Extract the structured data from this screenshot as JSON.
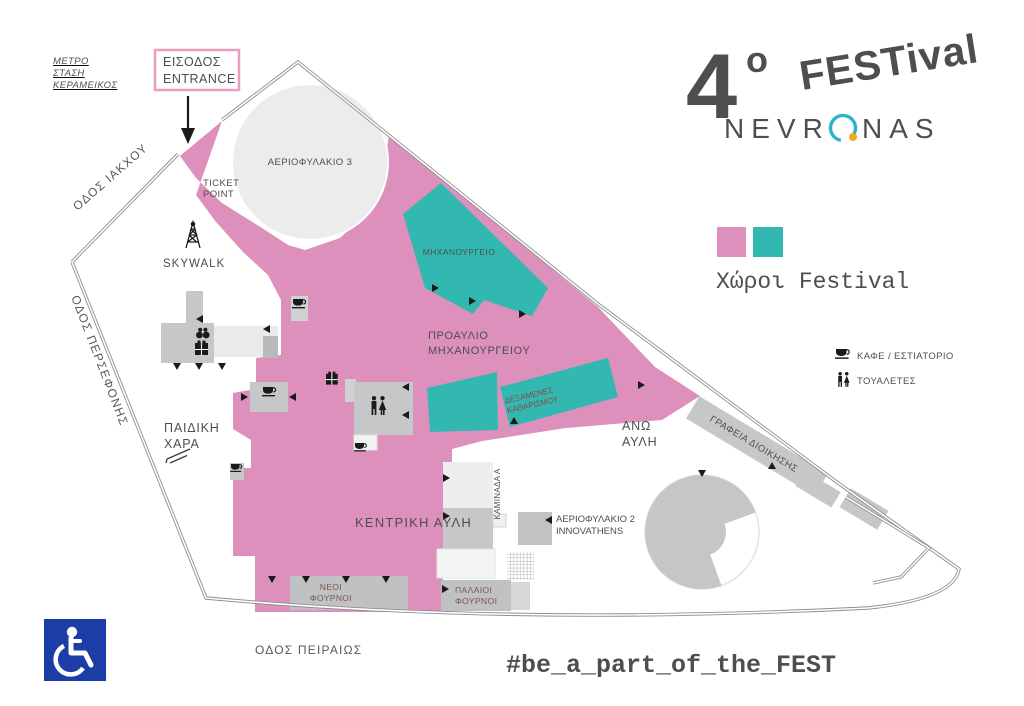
{
  "colors": {
    "festival_pink": "#dd90bc",
    "festival_teal": "#33b8b1",
    "building_gray": "#c5c7c9",
    "building_light": "#e9eaeb",
    "outline_gray": "#8d8f91",
    "label_dark": "#4d4e50",
    "label_brown": "#7d5648",
    "label_maroon": "#8a4a42",
    "logo_pink": "#d791bf",
    "logo_teal_arc": "#2bb3c8",
    "logo_orange_dot": "#f8a51b",
    "accessibility_blue": "#1d3da6",
    "entrance_box_border": "#ed9dc3"
  },
  "logo": {
    "number": "4",
    "ordinal": "o",
    "festival": "FESTival",
    "brand_left": "NEVR",
    "brand_right": "NAS"
  },
  "legend": {
    "title": "Χώροι Festival",
    "cafe": "ΚΑΦΕ / ΕΣΤΙΑΤΟΡΙΟ",
    "toilets": "ΤΟΥΑΛΕΤΕΣ"
  },
  "hashtag": "#be_a_part_of_the_FEST",
  "entrance": {
    "line1": "ΕΙΣΟΔΟΣ",
    "line2": "ENTRANCE"
  },
  "metro": {
    "line1": "ΜΕΤΡΟ",
    "line2": "ΣΤΑΣΗ",
    "line3": "ΚΕΡΑΜΕΙΚΟΣ"
  },
  "streets": {
    "iakchou": "ΟΔΟΣ ΙΑΚΧΟΥ",
    "persefonis": "ΟΔΟΣ ΠΕΡΣΕΦΟΝΗΣ",
    "peiraios": "ΟΔΟΣ ΠΕΙΡΑΙΩΣ"
  },
  "labels": {
    "ticket_point": {
      "line1": "TICKET",
      "line2": "POINT"
    },
    "skywalk": "SKYWALK",
    "gasholder3": "ΑΕΡΙΟΦΥΛΑΚΙΟ 3",
    "machine_shop": "ΜΗΧΑΝΟΥΡΓΕΙΟ",
    "machine_shop_forecourt": {
      "line1": "ΠΡΟΑΥΛΙΟ",
      "line2": "ΜΗΧΑΝΟΥΡΓΕΙΟΥ"
    },
    "purification_tanks": {
      "line1": "ΔΕΞΑΜΕΝΕΣ",
      "line2": "ΚΑΘΑΡΙΣΜΟΥ"
    },
    "upper_courtyard": {
      "line1": "ΑΝΩ",
      "line2": "ΑΥΛΗ"
    },
    "playground": {
      "line1": "ΠΑΙΔΙΚΗ",
      "line2": "ΧΑΡΑ"
    },
    "central_courtyard": "ΚΕΝΤΡΙΚΗ ΑΥΛΗ",
    "new_ovens": {
      "line1": "ΝΕΟΙ",
      "line2": "ΦΟΥΡΝΟΙ"
    },
    "old_ovens": {
      "line1": "ΠΑΛΑΙΟΙ",
      "line2": "ΦΟΥΡΝΟΙ"
    },
    "chimney_a": "ΚΑΜΙΝΑΔΑ Α",
    "gasholder2": {
      "line1": "ΑΕΡΙΟΦΥΛΑΚΙΟ 2",
      "line2": "INNOVATHENS"
    },
    "admin_offices": "ΓΡΑΦΕΙΑ ΔΙΟΙΚΗΣΗΣ"
  }
}
